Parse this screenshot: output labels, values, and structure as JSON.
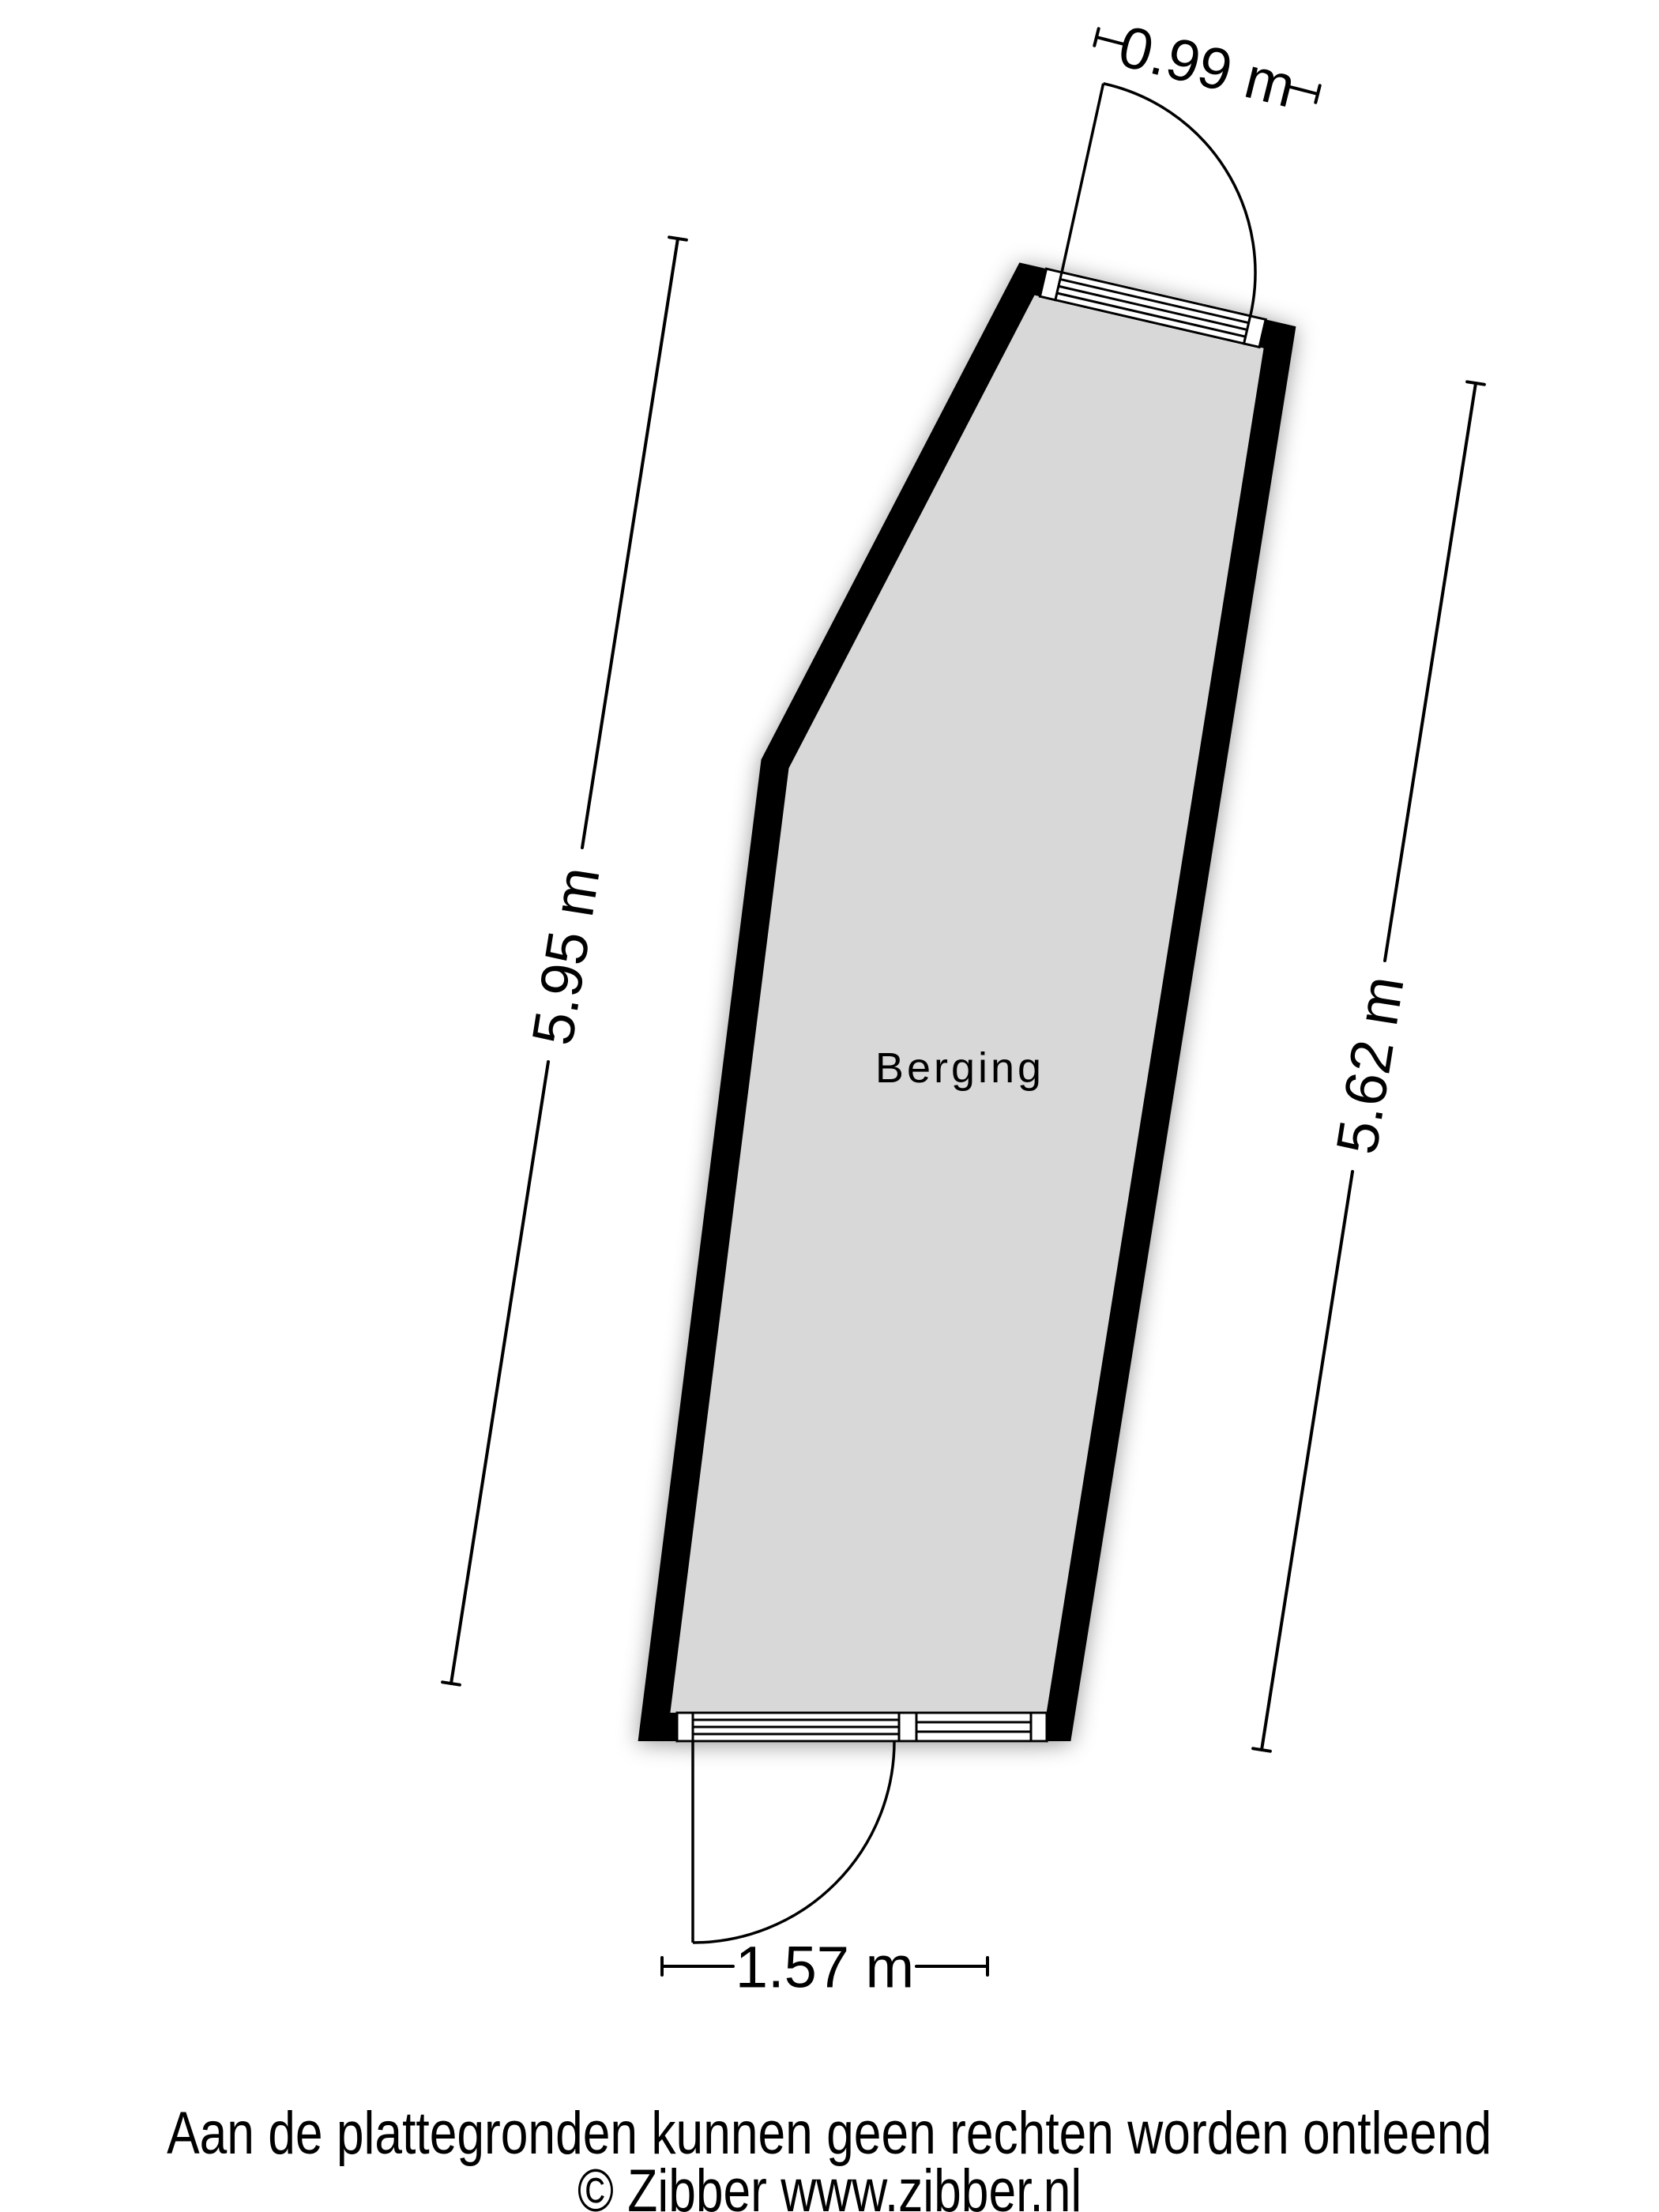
{
  "floorplan": {
    "room_label": "Berging",
    "dimensions": {
      "top": "0.99 m",
      "left": "5.95 m",
      "right": "5.62 m",
      "bottom": "1.57 m"
    },
    "colors": {
      "wall": "#000000",
      "floor": "#d8d8d8",
      "line": "#000000",
      "background": "#ffffff"
    }
  },
  "footer": {
    "disclaimer": "Aan de plattegronden kunnen geen rechten worden ontleend",
    "copyright": "© Zibber www.zibber.nl"
  }
}
